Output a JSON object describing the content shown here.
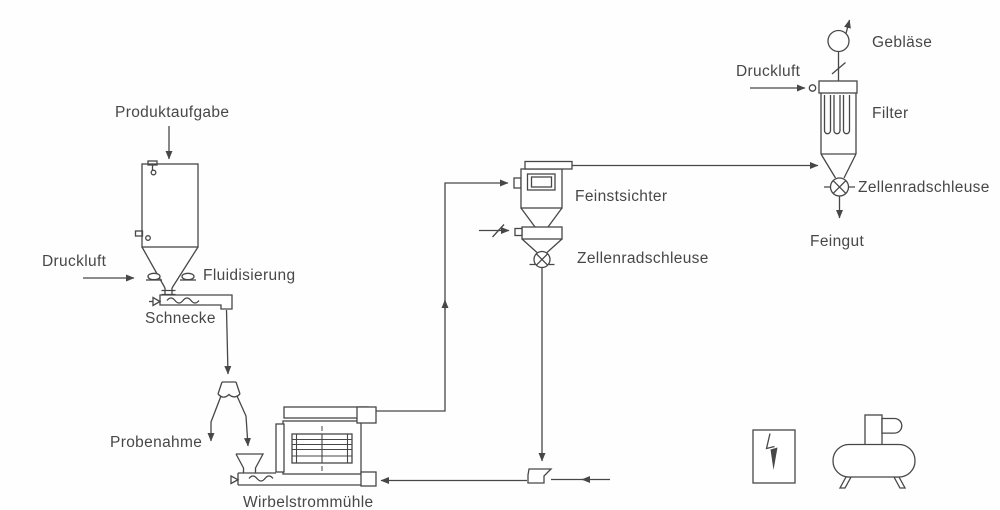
{
  "labels": {
    "produktaufgabe": "Produktaufgabe",
    "druckluft_silo": "Druckluft",
    "fluidisierung": "Fluidisierung",
    "schnecke": "Schnecke",
    "probenahme": "Probenahme",
    "wirbelstrommuehle": "Wirbelstrommühle",
    "feinstsichter": "Feinstsichter",
    "zellenradschleuse_sichter": "Zellenradschleuse",
    "druckluft_filter": "Druckluft",
    "geblaese": "Gebläse",
    "filter": "Filter",
    "zellenradschleuse_filter": "Zellenradschleuse",
    "feingut": "Feingut"
  },
  "colors": {
    "line": "#474747",
    "text": "#474747",
    "background": "#fefefe"
  },
  "diagram": {
    "type": "process-flow",
    "language": "de",
    "nodes": [
      {
        "id": "product-feed",
        "label": "Produktaufgabe"
      },
      {
        "id": "feed-silo",
        "label": ""
      },
      {
        "id": "compressed-air-silo",
        "label": "Druckluft"
      },
      {
        "id": "fluidization",
        "label": "Fluidisierung"
      },
      {
        "id": "screw-conveyor",
        "label": "Schnecke"
      },
      {
        "id": "sample-splitter",
        "label": ""
      },
      {
        "id": "sampling",
        "label": "Probenahme"
      },
      {
        "id": "vortex-mill",
        "label": "Wirbelstrommühle"
      },
      {
        "id": "fine-classifier",
        "label": "Feinstsichter"
      },
      {
        "id": "rotary-valve-classifier",
        "label": "Zellenradschleuse"
      },
      {
        "id": "return-injector",
        "label": ""
      },
      {
        "id": "filter",
        "label": "Filter"
      },
      {
        "id": "compressed-air-filter",
        "label": "Druckluft"
      },
      {
        "id": "blower",
        "label": "Gebläse"
      },
      {
        "id": "rotary-valve-filter",
        "label": "Zellenradschleuse"
      },
      {
        "id": "fine-product",
        "label": "Feingut"
      },
      {
        "id": "control-cabinet-symbol",
        "label": ""
      },
      {
        "id": "compressor-symbol",
        "label": ""
      }
    ],
    "connections": [
      [
        "product-feed",
        "feed-silo"
      ],
      [
        "compressed-air-silo",
        "fluidization"
      ],
      [
        "feed-silo",
        "screw-conveyor"
      ],
      [
        "screw-conveyor",
        "sample-splitter"
      ],
      [
        "sample-splitter",
        "sampling"
      ],
      [
        "sample-splitter",
        "vortex-mill"
      ],
      [
        "vortex-mill",
        "fine-classifier"
      ],
      [
        "fine-classifier",
        "rotary-valve-classifier"
      ],
      [
        "rotary-valve-classifier",
        "return-injector"
      ],
      [
        "return-injector",
        "vortex-mill"
      ],
      [
        "fine-classifier",
        "filter"
      ],
      [
        "compressed-air-filter",
        "filter"
      ],
      [
        "filter",
        "blower"
      ],
      [
        "filter",
        "rotary-valve-filter"
      ],
      [
        "rotary-valve-filter",
        "fine-product"
      ]
    ]
  }
}
